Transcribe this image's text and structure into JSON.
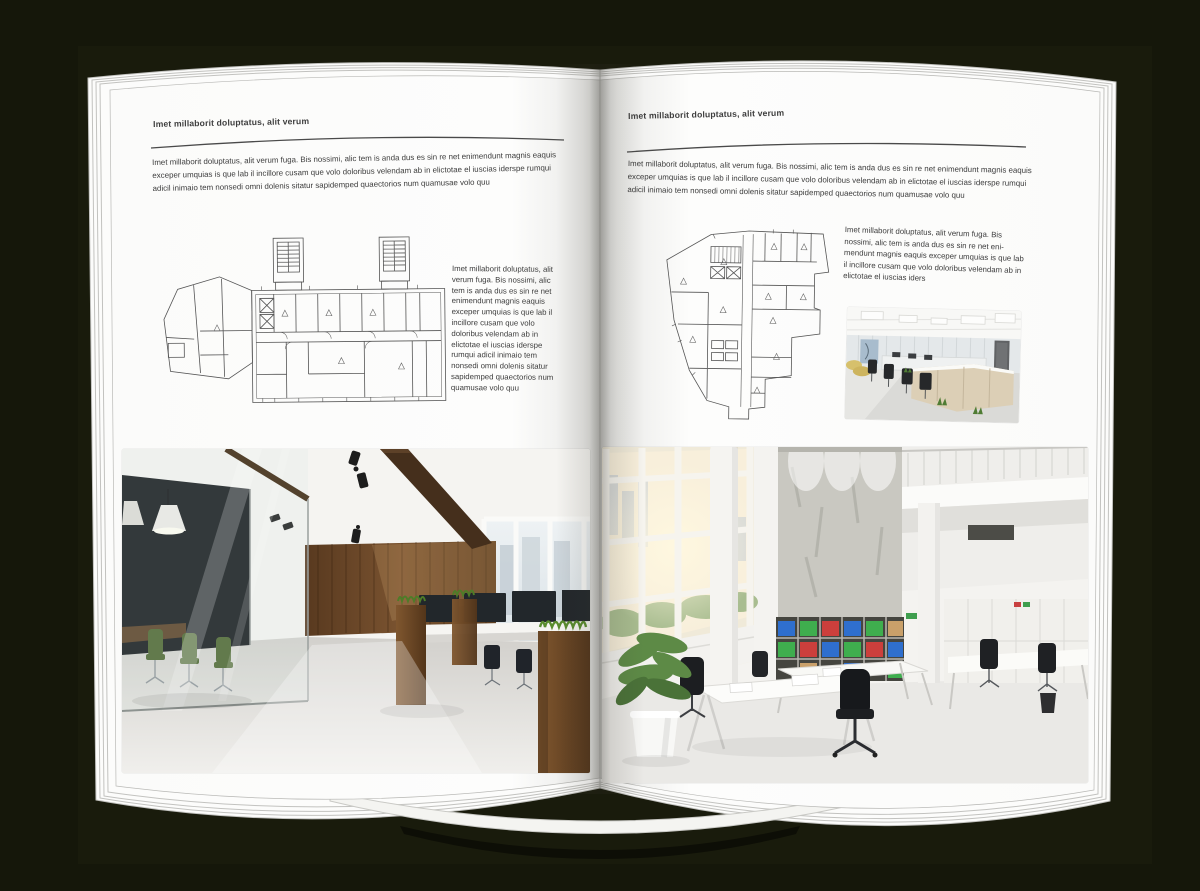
{
  "palette": {
    "backdrop": "#15170a",
    "page": "#fbfbfa",
    "text": "#3c3c3c",
    "rule": "#4a4a4a",
    "plan_line": "#555555",
    "wood_wall": "#6a4527",
    "meeting_chair_green": "#4d6630",
    "binder_blue": "#2f6fce",
    "binder_green": "#3fae4e",
    "binder_red": "#cc3f3c"
  },
  "left_page": {
    "header": "Imet millaborit doluptatus, alit verum",
    "intro": "Imet millaborit doluptatus, alit verum fuga. Bis nossimi, alic tem is anda dus es sin re net enimendunt magnis eaquis exceper umquias is que lab il incillore cusam que volo doloribus velendam ab in elictotae el iuscias iderspe rumqui adicil inimaio tem nonsedi omni dolenis sitatur sapidemped quaectorios num quamusae volo quu",
    "side_text": "Imet millaborit doluptatus, alit verum fuga. Bis nossimi, alic tem is anda dus es sin re net enimendunt magnis eaquis exceper umquias is que lab il incillore cusam que volo doloribus velendam ab in elictotae el iuscias iderspe rumqui adicil inimaio tem nonsedi omni dolenis sitatur sapidemped quaectorios num quamusae volo quu"
  },
  "right_page": {
    "header": "Imet millaborit doluptatus, alit verum",
    "intro": "Imet millaborit doluptatus, alit verum fuga. Bis nossimi, alic tem is anda dus es sin re net enimendunt magnis eaquis exceper umquias is que lab il incillore cusam que volo doloribus velendam ab in elictotae el iuscias iderspe rumqui adicil inimaio tem nonsedi omni dolenis sitatur sapidemped quaectorios num quamusae volo quu",
    "side_text": "Imet millaborit doluptatus, alit verum fuga. Bis nossimi, alic tem is anda dus es sin re net eni-mendunt magnis eaquis exceper umquias is que lab il incillore cusam que volo doloribus velendam ab in elictotae el iuscias iders"
  }
}
